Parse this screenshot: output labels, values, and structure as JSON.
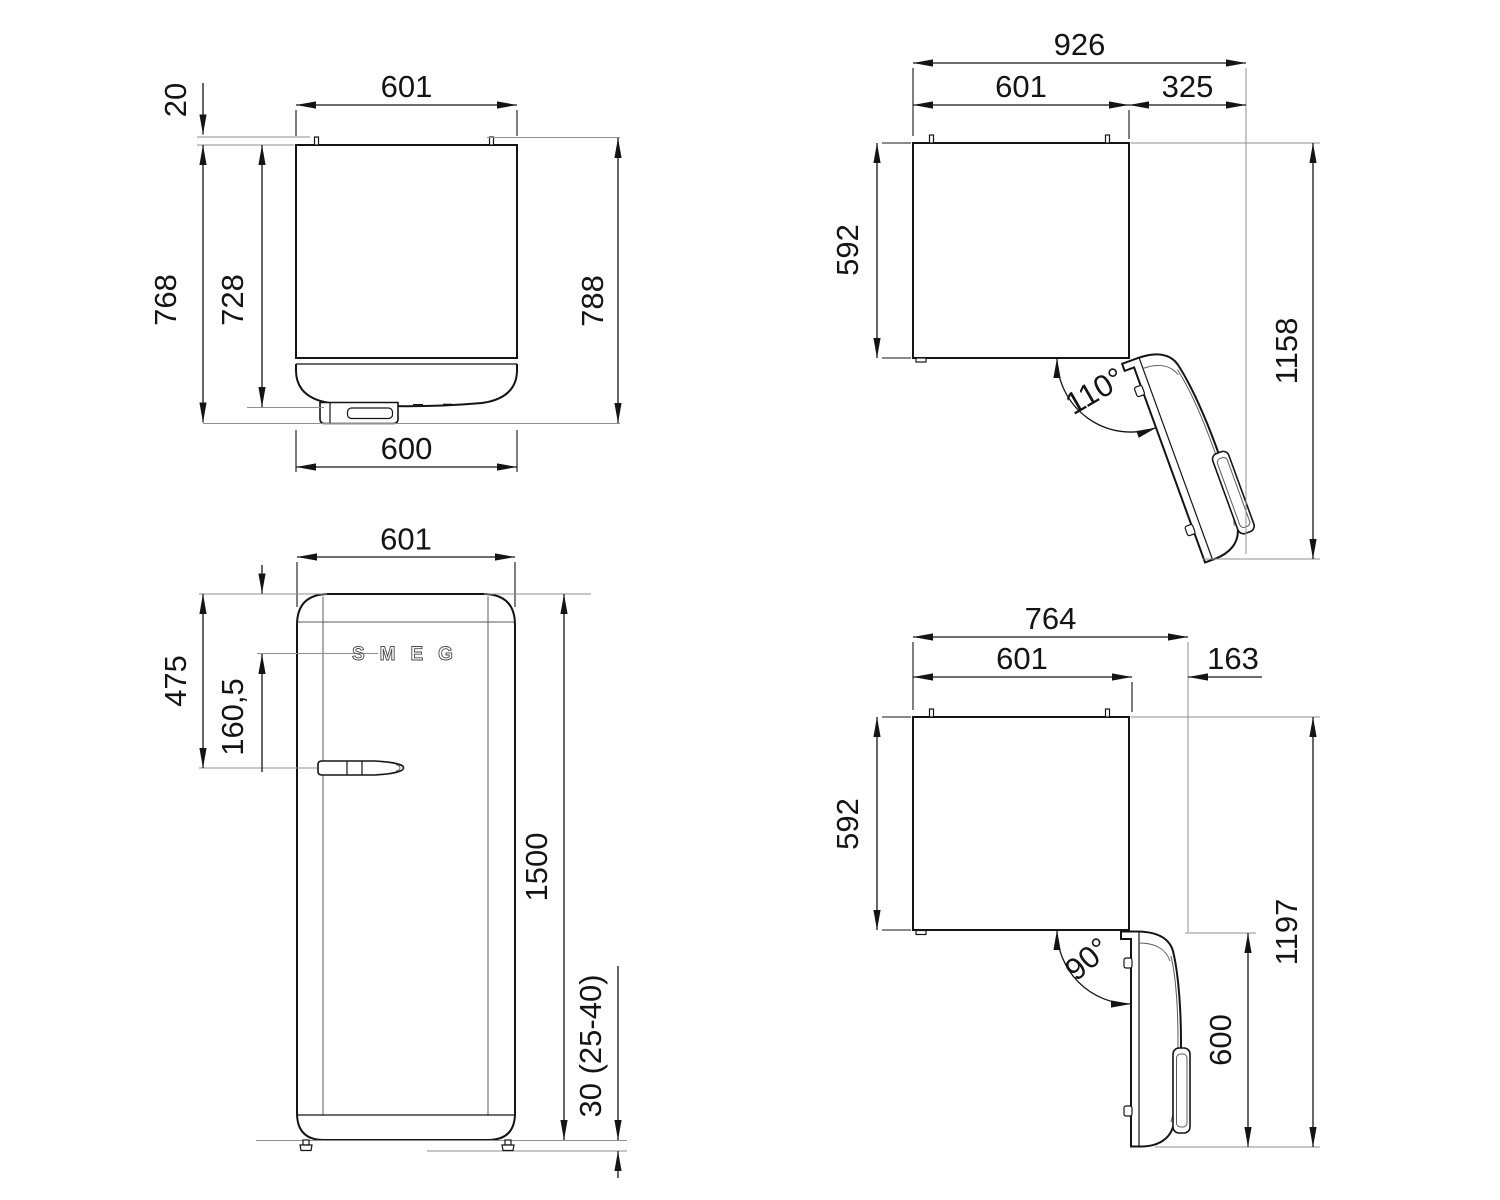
{
  "page": {
    "background": "#ffffff",
    "line_color": "#141414",
    "thin_line_color": "#8f8f8f"
  },
  "views": {
    "top_closed": {
      "labels": {
        "width_top": "601",
        "rear_spacer_depth": "20",
        "depth_to_handle_front": "768",
        "depth_to_door_front": "728",
        "depth_overall": "788",
        "door_width": "600"
      }
    },
    "top_open_110": {
      "labels": {
        "overall_width": "926",
        "cabinet_width": "601",
        "door_projection": "325",
        "cabinet_depth": "592",
        "overall_depth": "1158",
        "door_angle": "110°"
      }
    },
    "front": {
      "logo": "SMEG",
      "labels": {
        "width": "601",
        "top_to_handle": "475",
        "top_to_logo": "160,5",
        "height": "1500",
        "feet_height": "30 (25-40)"
      }
    },
    "top_open_90": {
      "labels": {
        "overall_width": "764",
        "cabinet_width": "601",
        "door_projection": "163",
        "cabinet_depth": "592",
        "overall_depth": "1197",
        "door_depth": "600",
        "door_angle": "90°"
      }
    }
  }
}
